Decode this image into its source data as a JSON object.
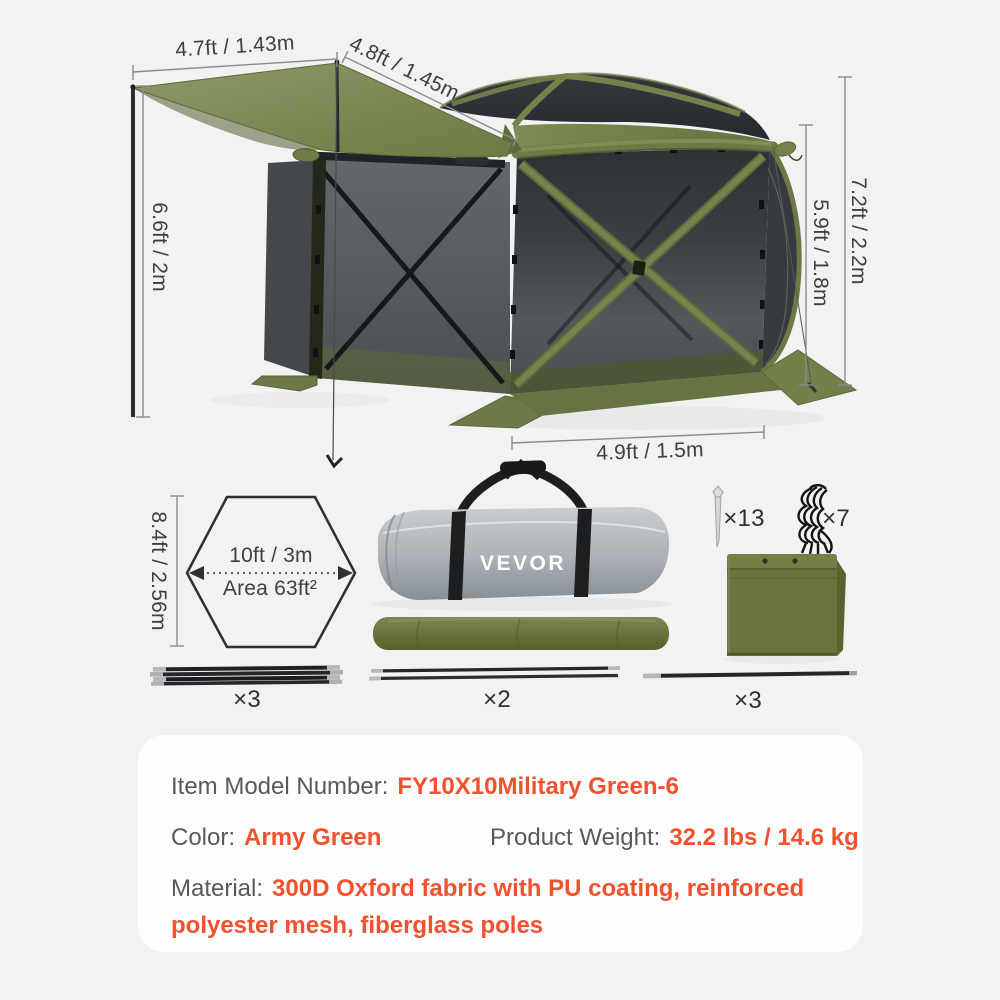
{
  "colors": {
    "accent_orange": "#F2512E",
    "army_green": "#76834D",
    "mesh_dark": "#33383C",
    "page_bg": "#F2F2F3",
    "panel_bg": "#FDFDFD"
  },
  "figure": {
    "dimensions": {
      "awning_width": "4.7ft / 1.43m",
      "roof_edge": "4.8ft / 1.45m",
      "pole_height": "6.6ft / 2m",
      "panel_height": "5.9ft / 1.8m",
      "total_height": "7.2ft / 2.2m",
      "base_width": "4.9ft / 1.5m"
    },
    "footprint": {
      "width": "10ft / 3m",
      "area": "Area 63ft²",
      "height": "8.4ft / 2.56m"
    },
    "accessories": {
      "stakes": "×13",
      "ropes": "×7",
      "pole_bundle": "×3",
      "pole_pair": "×2",
      "pole_single": "×3"
    },
    "bag_logo": "VEVOR"
  },
  "panel": {
    "model_label": "Item Model Number:",
    "model_value": "FY10X10Military Green-6",
    "color_label": "Color:",
    "color_value": "Army Green",
    "weight_label": "Product Weight:",
    "weight_value": "32.2 lbs / 14.6 kg",
    "material_label": "Material:",
    "material_value": "300D Oxford fabric with PU coating, reinforced polyester mesh, fiberglass poles"
  }
}
